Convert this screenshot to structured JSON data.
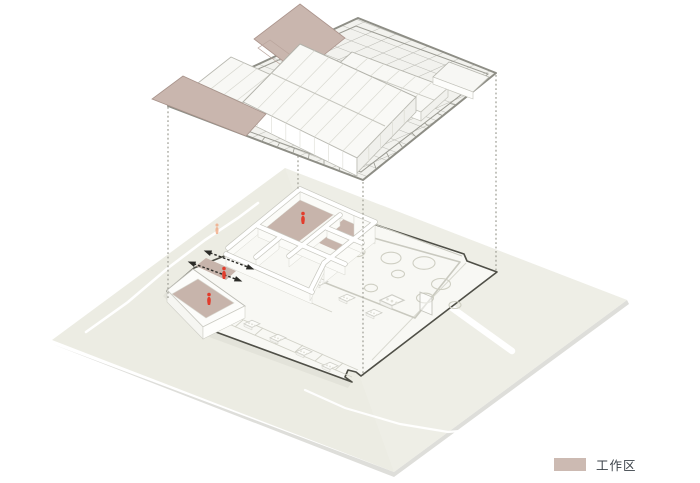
{
  "legend": {
    "swatch_color": "#ccbab2",
    "label": "工作区"
  },
  "palette": {
    "work_area": "#c7b4ab",
    "work_area_slab": "#c9b6ae",
    "ground": "#ecece3",
    "floor": "#f8f8f4",
    "outline": "#4f4f47",
    "grid": "#8e8e86",
    "figure_red": "#e23c2c",
    "figure_orange": "#f0a47e",
    "path_white": "#ffffff"
  },
  "diagram": {
    "type": "axonometric-exploded-building-diagram",
    "layers": [
      {
        "name": "roof-assembly"
      },
      {
        "name": "floor-plan"
      },
      {
        "name": "site-ground"
      }
    ],
    "projection_line_count": 4,
    "red_figure_count": 3,
    "orange_figure_count": 1,
    "double_arrow_count": 2
  }
}
